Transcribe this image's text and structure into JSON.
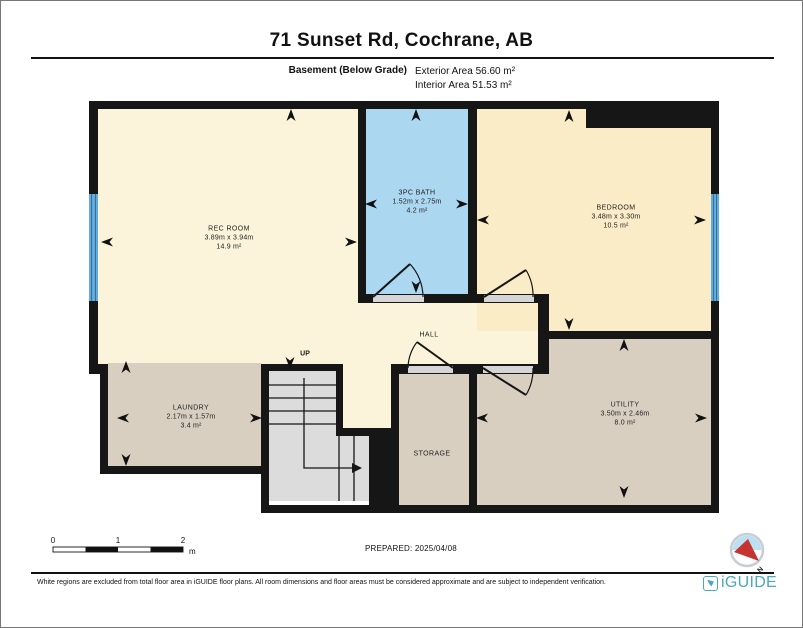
{
  "header": {
    "title": "71 Sunset Rd, Cochrane, AB",
    "floor_label": "Basement (Below Grade)",
    "exterior_area": "Exterior Area 56.60 m²",
    "interior_area": "Interior Area 51.53 m²"
  },
  "rooms": {
    "rec_room": {
      "name": "REC ROOM",
      "dims": "3.89m x 3.94m",
      "area": "14.9 m²"
    },
    "bath": {
      "name": "3PC BATH",
      "dims": "1.52m x 2.75m",
      "area": "4.2 m²"
    },
    "bedroom": {
      "name": "BEDROOM",
      "dims": "3.48m x 3.30m",
      "area": "10.5 m²"
    },
    "hall": {
      "name": "HALL"
    },
    "laundry": {
      "name": "LAUNDRY",
      "dims": "2.17m x 1.57m",
      "area": "3.4 m²"
    },
    "storage": {
      "name": "STORAGE"
    },
    "utility": {
      "name": "UTILITY",
      "dims": "3.50m x 2.46m",
      "area": "8.0 m²"
    }
  },
  "stairs": {
    "label": "UP"
  },
  "scale_bar": {
    "ticks": [
      "0",
      "1",
      "2"
    ],
    "unit": "m"
  },
  "prepared_label": "PREPARED: 2025/04/08",
  "compass": {
    "north": "N"
  },
  "footer": {
    "disclaimer": "White regions are excluded from total floor area in iGUIDE floor plans. All room dimensions and floor areas must be considered approximate and are subject to independent verification.",
    "brand": "iGUIDE"
  },
  "colors": {
    "cream": "#FBF4DB",
    "bedroom_cream": "#F9ECC7",
    "bath_blue": "#ACD7F0",
    "tan": "#D9CFC1",
    "stair_gray": "#DCDCDC",
    "door_gray": "#D5D5D5",
    "window_blue": "#63ACDA",
    "window_stripe": "#2F72A0",
    "wall": "#161616",
    "brand_teal": "#4BA7BD",
    "compass_red": "#C53430",
    "compass_blue": "#BDDFF2"
  }
}
